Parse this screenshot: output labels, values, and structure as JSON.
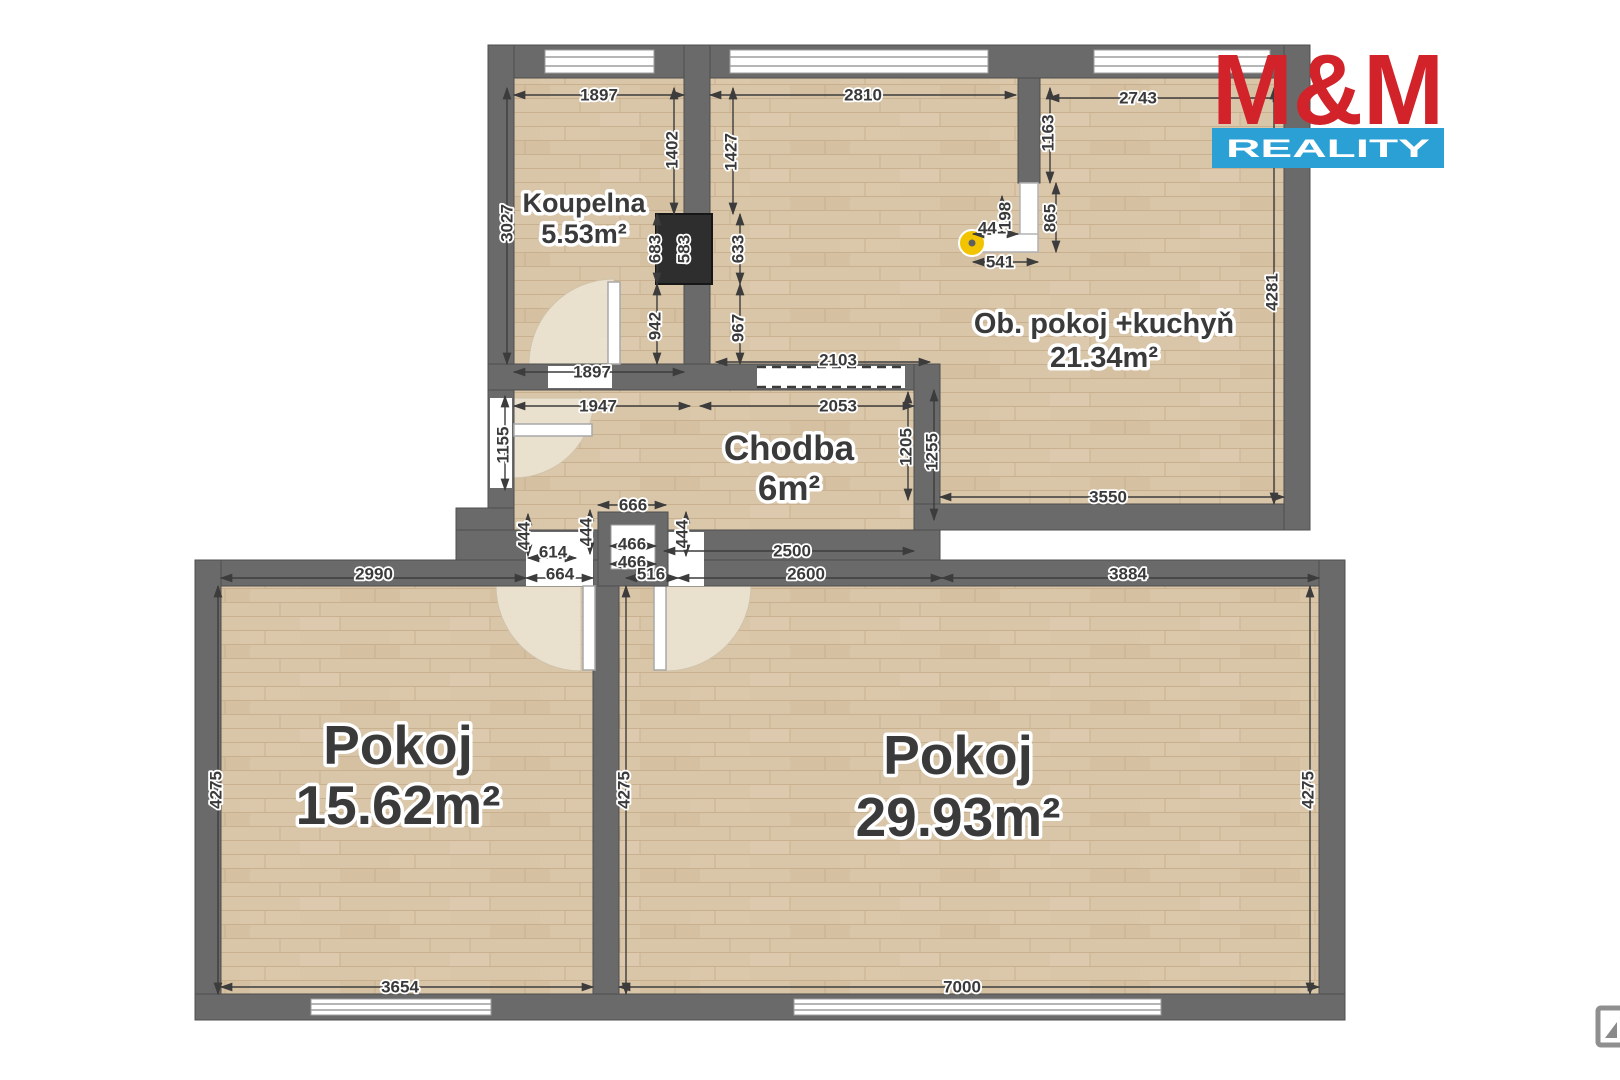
{
  "rooms": {
    "bathroom": {
      "name": "Koupelna",
      "area": "5.53m²"
    },
    "living": {
      "name": "Ob. pokoj +kuchyň",
      "area": "21.34m²"
    },
    "hall": {
      "name": "Chodba",
      "area": "6m²"
    },
    "room1": {
      "name": "Pokoj",
      "area": "15.62m²"
    },
    "room2": {
      "name": "Pokoj",
      "area": "29.93m²"
    }
  },
  "dims": {
    "bath_top": "1897",
    "living_top": "2810",
    "living_top_right": "2743",
    "bath_left": "3027",
    "bath_right_up": "1402",
    "living_left_up": "1427",
    "kitchen_stub": "1163",
    "kitchen_gap": "198",
    "kitchen_side": "865",
    "kitchen_top": "441",
    "kitchen_bottom": "541",
    "shaft_left": "683",
    "shaft_mid": "583",
    "shaft_right": "633",
    "bath_right_low": "942",
    "living_left_low": "967",
    "bath_bottom": "1897",
    "pass_top": "2103",
    "hall_top_left": "1947",
    "hall_top_right": "2053",
    "living_right": "4281",
    "living_bottom": "3550",
    "entry": "1155",
    "hall_right_in": "1205",
    "hall_right_out": "1255",
    "box_top": "666",
    "box_in1": "466",
    "box_in2": "466",
    "n444a": "444",
    "n444b": "444",
    "n444c": "444",
    "n614": "614",
    "hall_bottom": "2500",
    "room1_top": "2990",
    "door1": "664",
    "door2": "516",
    "room2_top_left": "2600",
    "room2_top_right": "3884",
    "room1_left": "4275",
    "room2_left": "4275",
    "room2_right": "4275",
    "room1_bottom": "3654",
    "room2_bottom": "7000"
  },
  "logo": {
    "line1": "M&M",
    "line2": "REALITY"
  },
  "colors": {
    "wall": "#6a6a6a",
    "floor": "#d9c6a8",
    "logo_red": "#d2232a",
    "logo_blue": "#2aa0d5",
    "marker_yellow": "#f2c400"
  }
}
